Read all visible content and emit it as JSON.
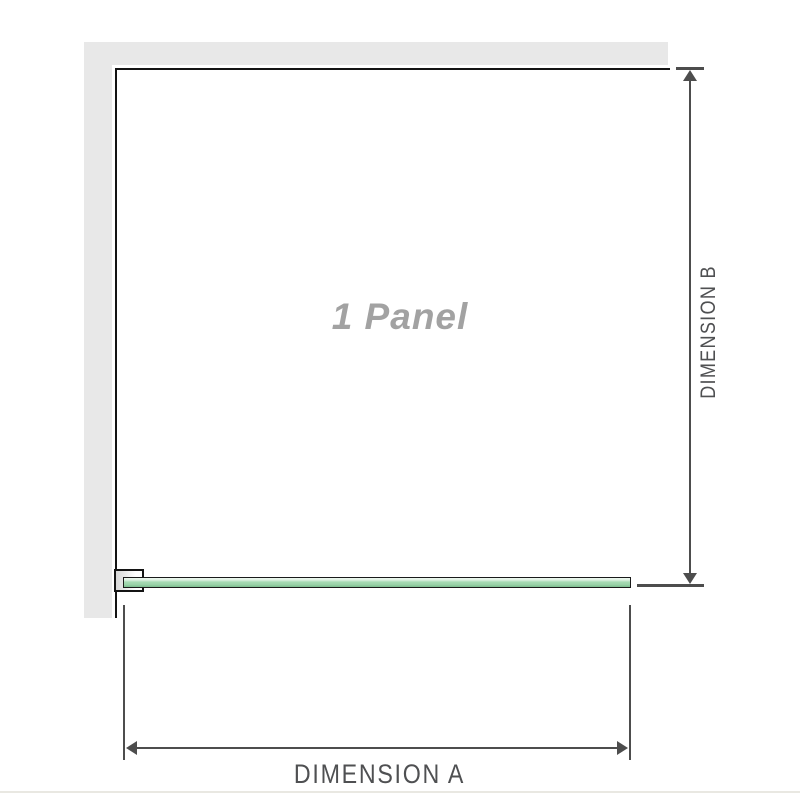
{
  "diagram": {
    "title": "Shower screen single panel dimension diagram",
    "panel_label": "1 Panel",
    "panel_count": 1,
    "dimension_a": {
      "label": "DIMENSION A",
      "axis": "horizontal",
      "measures": "panel width"
    },
    "dimension_b": {
      "label": "DIMENSION B",
      "axis": "vertical",
      "measures": "panel height"
    },
    "icons": [
      "arrow-up-icon",
      "arrow-down-icon",
      "arrow-left-icon",
      "arrow-right-icon"
    ],
    "colors": {
      "background": "#ffffff",
      "wall_gray": "#e8e8e8",
      "outline_black": "#141414",
      "glass_green": "#a6dab3",
      "glass_highlight": "#eef8f0",
      "glass_shadow": "#7cbe8f",
      "dimension_line_gray": "#4d4d4d",
      "dimension_text_gray": "#4f5052",
      "panel_label_gray": "#a2a2a2",
      "footer_line": "#e9e8e2"
    }
  }
}
